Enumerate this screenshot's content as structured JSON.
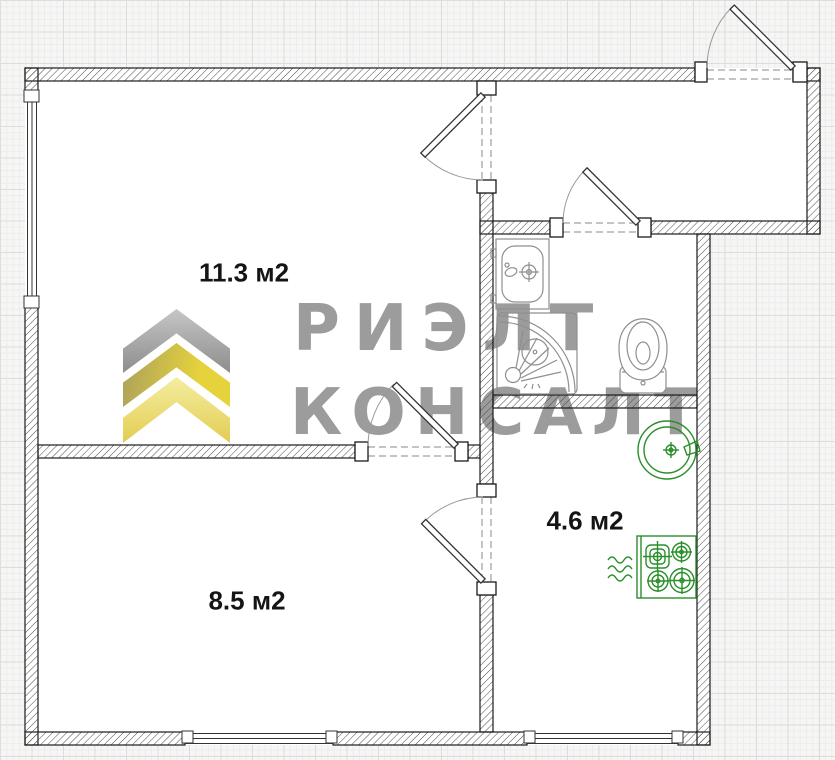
{
  "plan": {
    "title": "apartment-floor-plan",
    "rooms": [
      {
        "name": "room-1",
        "area_label": "11.3 м2"
      },
      {
        "name": "room-2",
        "area_label": "8.5 м2"
      },
      {
        "name": "kitchen",
        "area_label": "4.6 м2"
      }
    ],
    "watermark": {
      "logo_line1": "РИЭЛТ",
      "logo_line2": "КОНСАЛТ"
    },
    "fixtures": [
      "bathroom-sink",
      "corner-shower",
      "toilet",
      "kitchen-sink",
      "gas-stove",
      "gas-supply-waves"
    ],
    "colors": {
      "kitchen_fixtures": "#2a8f2a",
      "bathroom_fixtures": "#8f8f8f",
      "wall_outline": "#1a1a1a",
      "watermark_text": "#9c9c9c",
      "chevron_silver": "#a9a9a9",
      "chevron_yellow": "#e3cf44",
      "chevron_pale_yellow": "#f0e699"
    }
  }
}
